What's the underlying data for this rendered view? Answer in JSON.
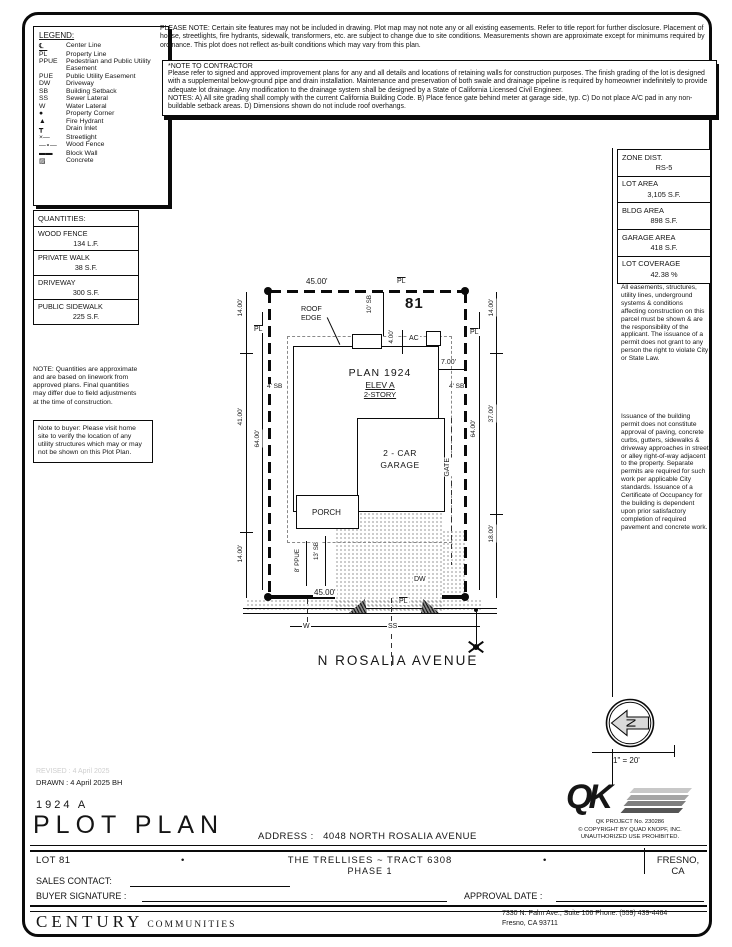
{
  "notes": {
    "please_note": "PLEASE NOTE:  Certain site features may not be included in drawing.  Plot map may not note any or all existing easements.  Refer to title report for further disclosure.  Placement of house, streetlights, fire hydrants, sidewalk, transformers, etc. are subject to change due to site conditions.  Measurements shown are approximate except for minimums required by ordinance.  This plot does not reflect as-built conditions which may vary from this plan.",
    "contractor_title": "*NOTE TO CONTRACTOR",
    "contractor_body": "Please refer to signed and approved improvement plans for any and all details and locations of retaining walls for construction purposes. The finish grading of the lot is designed with a supplemental below-ground pipe and drain installation.  Maintenance and preservation of both swale and drainage pipeline is required by homeowner indefinitely to provide adequate lot drainage.  Any modification to the drainage system shall be designed by a State of California Licensed Civil Engineer.",
    "contractor_notes": "NOTES:  A) All site grading shall comply with the current California Building Code.  B) Place fence gate behind meter at garage side, typ.  C) Do not place A/C pad in any non-buildable setback areas.  D) Dimensions shown do not include roof overhangs."
  },
  "legend": {
    "title": "LEGEND:",
    "items": [
      {
        "sym": "℄",
        "label": "Center Line"
      },
      {
        "sym": "PL",
        "label": "Property Line"
      },
      {
        "sym": "PPUE",
        "label": "Pedestrian and Public Utility Easement"
      },
      {
        "sym": "PUE",
        "label": "Public Utility Easement"
      },
      {
        "sym": "DW",
        "label": "Driveway"
      },
      {
        "sym": "SB",
        "label": "Building Setback"
      },
      {
        "sym": "SS",
        "label": "Sewer Lateral"
      },
      {
        "sym": "W",
        "label": "Water Lateral"
      },
      {
        "sym": "●",
        "label": "Property Corner"
      },
      {
        "sym": "▲",
        "label": "Fire Hydrant"
      },
      {
        "sym": "┳",
        "label": "Drain Inlet"
      },
      {
        "sym": "×—",
        "label": "Streetlight"
      },
      {
        "sym": "—∘—",
        "label": "Wood Fence"
      },
      {
        "sym": "▬▬",
        "label": "Block Wall"
      },
      {
        "sym": "▨",
        "label": "Concrete"
      }
    ]
  },
  "quantities": {
    "title": "QUANTITIES:",
    "rows": [
      {
        "label": "WOOD FENCE",
        "value": "134 L.F."
      },
      {
        "label": "PRIVATE WALK",
        "value": "38 S.F."
      },
      {
        "label": "DRIVEWAY",
        "value": "300 S.F."
      },
      {
        "label": "PUBLIC SIDEWALK",
        "value": "225 S.F."
      }
    ],
    "note": "NOTE: Quantities are approximate and are based on linework from approved plans.  Final quantities may differ due to field adjustments at the time of construction.",
    "buyer_note": "Note to buyer: Please visit home site to verify the location of any utility structures which may or may not be shown on this Plot Plan."
  },
  "zoning": {
    "rows": [
      {
        "label": "ZONE DIST.",
        "value": "RS-5"
      },
      {
        "label": "LOT AREA",
        "value": "3,105 S.F."
      },
      {
        "label": "BLDG AREA",
        "value": "898 S.F."
      },
      {
        "label": "GARAGE AREA",
        "value": "418 S.F."
      },
      {
        "label": "LOT COVERAGE",
        "value": "42.38 %"
      }
    ],
    "easements_note": "All easements, structures, utility lines, underground systems & conditions affecting construction on this parcel must be shown & are the responsibility of the applicant. The issuance of a permit does not grant to any person the right to violate City or State Law.",
    "permit_note": "Issuance of the building permit does not constitute approval of paving, concrete curbs, gutters, sidewalks & driveway approaches in street or alley right-of-way adjacent to the property. Separate permits are required for such work per applicable City standards. Issuance of a Certificate of Occupancy for the building is dependent upon prior satisfactory completion of required pavement and concrete work."
  },
  "plot": {
    "lot_number": "81",
    "plan": "PLAN 1924",
    "elev": "ELEV A",
    "story": "2-STORY",
    "roof_edge": "ROOF\nEDGE",
    "ac": "AC",
    "garage": "2 - CAR\nGARAGE",
    "porch": "PORCH",
    "gate": "GATE",
    "dw": "DW",
    "pl": "PL",
    "w": "W",
    "ss": "SS",
    "street": "N ROSALIA AVENUE",
    "scale": "1\" = 20'",
    "north": "N",
    "dims": {
      "top_width": "45.00'",
      "bottom_width": "45.00'",
      "left": [
        "14.00'",
        "41.00'",
        "14.00'"
      ],
      "left_inner": "64.00'",
      "right": [
        "14.00'",
        "37.00'",
        "18.00'"
      ],
      "right_inner": "64.00'",
      "sb_top": "10' SB",
      "sb_left": "4' SB",
      "sb_right": "4' SB",
      "sb_front": "13' SB",
      "ppue": "8' PPUE",
      "ac_offset": "4.00'",
      "garage_offset": "7.00'"
    }
  },
  "titleblock": {
    "revised": "REVISED :  4 April 2025",
    "drawn": "DRAWN :  4 April 2025   BH",
    "plan_number": "1924   A",
    "title": "PLOT PLAN",
    "address_label": "ADDRESS :",
    "address": "4048 NORTH ROSALIA AVENUE",
    "lot": "LOT 81",
    "bullet": "•",
    "tract": "THE TRELLISES ~ TRACT 6308",
    "phase": "PHASE 1",
    "city": "FRESNO, CA",
    "sales_contact_label": "SALES CONTACT:",
    "buyer_signature_label": "BUYER SIGNATURE :",
    "approval_date_label": "APPROVAL DATE :"
  },
  "qk": {
    "logo": "QK",
    "project": "QK PROJECT No. 230286",
    "copyright": "©  COPYRIGHT BY QUAD KNOPF, INC.",
    "unauthorized": "UNAUTHORIZED USE PROHIBITED."
  },
  "footer": {
    "builder_name": "CENTURY",
    "builder_suffix": "COMMUNITIES",
    "address_line1": "7330 N. Palm Ave., Suite 106     Phone:  (559) 439-4464",
    "address_line2": "Fresno, CA  93711"
  }
}
